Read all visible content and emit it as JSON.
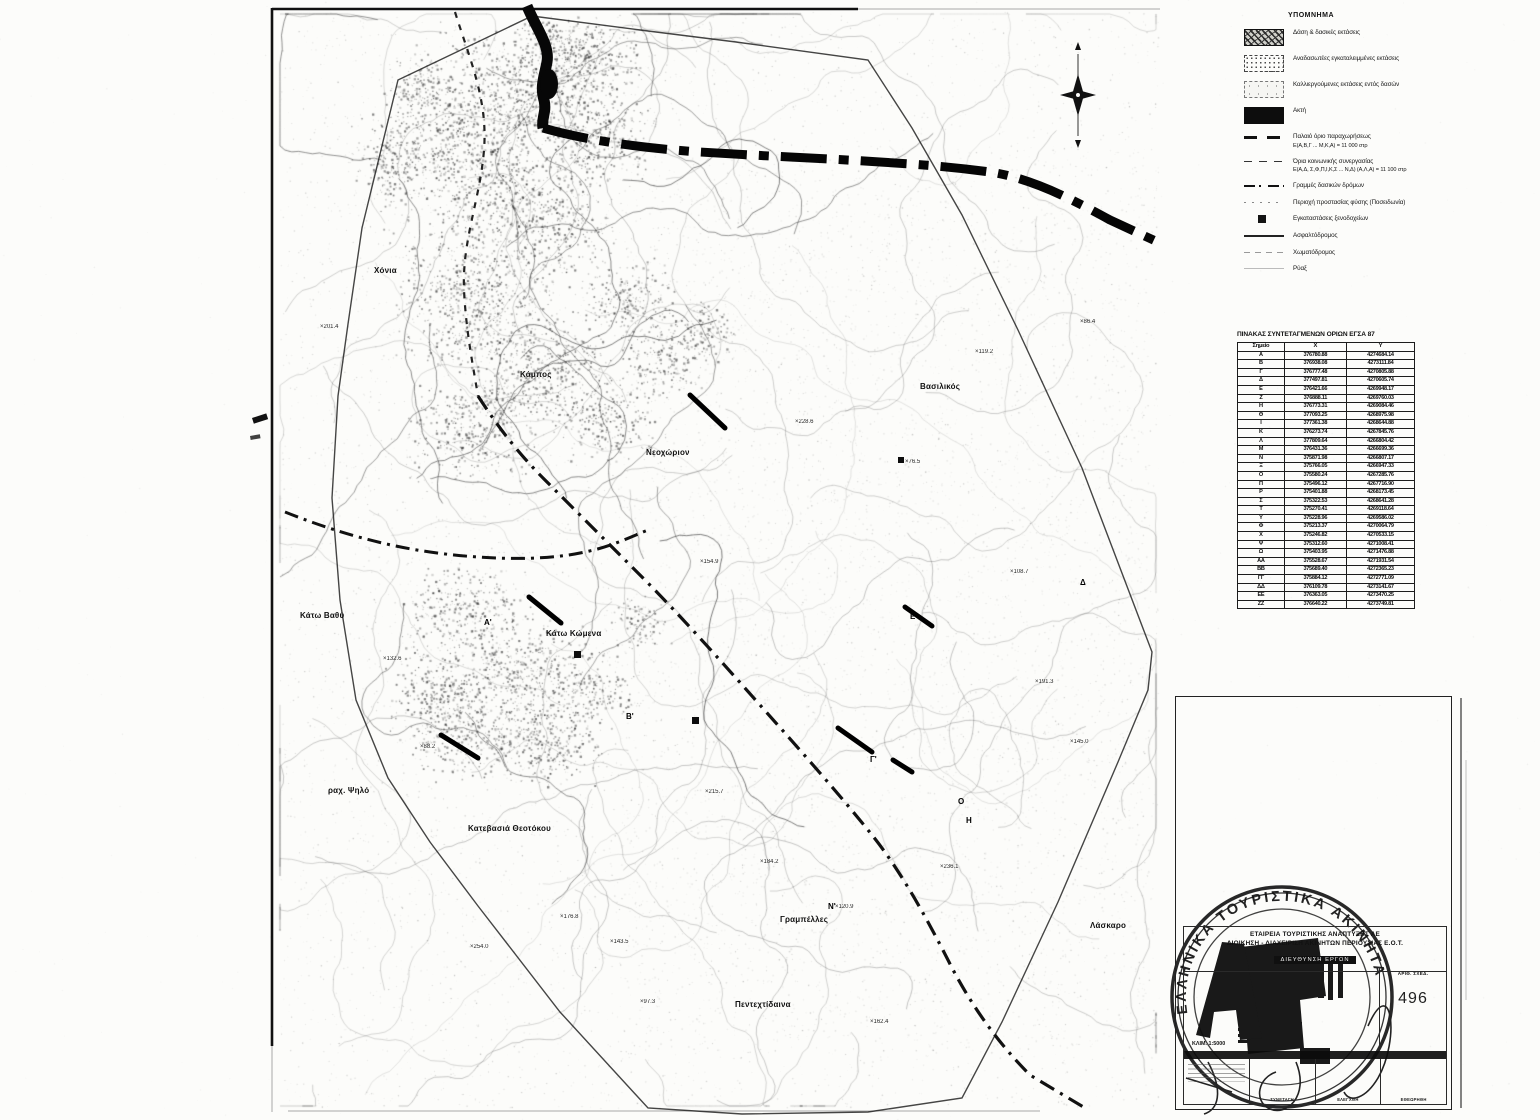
{
  "legend": {
    "title": "ΥΠΟΜΝΗΜΑ",
    "items": [
      {
        "type": "swatch-forest",
        "label": "Δάση & δασικές εκτάσεις"
      },
      {
        "type": "swatch-reforest",
        "label": "Αναδασωτέες εγκαταλειμμένες εκτάσεις"
      },
      {
        "type": "swatch-cultivated",
        "label": "Καλλιεργούμενες εκτάσεις εντός δασών"
      },
      {
        "type": "swatch-coast",
        "label": "Ακτή"
      },
      {
        "type": "line-old-boundary",
        "label": "Παλαιό όριο παραχωρήσεως",
        "sub": "Ε(Α,Β,Γ ... Μ,Κ,Α) = 11 000 στρ"
      },
      {
        "type": "line-common-boundary",
        "label": "Όρια κοινωνικής συνεργασίας",
        "sub": "Ε(Α,Δ, Σ,Φ,Π,Ι,Κ,Σ ... Ν,Δ) (Α,Λ,Α) = 11 100 στρ"
      },
      {
        "type": "line-forest-road",
        "label": "Γραμμές δασικών δρόμων"
      },
      {
        "type": "line-protection",
        "label": "Περιοχή προστασίας φύσης (Ποσειδωνία)"
      },
      {
        "type": "marker-hotel",
        "label": "Εγκαταστάσεις ξενοδοχείων"
      },
      {
        "type": "line-asphalt",
        "label": "Ασφαλτόδρομος"
      },
      {
        "type": "line-dirt",
        "label": "Χωματόδρομος"
      },
      {
        "type": "line-stream",
        "label": "Ρύαξ"
      }
    ]
  },
  "coords_table": {
    "title": "ΠΙΝΑΚΑΣ ΣΥΝΤΕΤΑΓΜΕΝΩΝ ΟΡΙΩΝ ΕΓΣΑ 87",
    "headers": [
      "Σημείο",
      "Χ",
      "Υ"
    ],
    "rows": [
      [
        "Α",
        "376780.88",
        "4274684.14"
      ],
      [
        "Β",
        "376938.08",
        "4273111.84"
      ],
      [
        "Γ",
        "376777.48",
        "4270805.88"
      ],
      [
        "Δ",
        "377497.81",
        "4270605.74"
      ],
      [
        "Ε",
        "376421.66",
        "4269948.17"
      ],
      [
        "Ζ",
        "376888.11",
        "4269760.03"
      ],
      [
        "Η",
        "376773.31",
        "4269084.46"
      ],
      [
        "Θ",
        "377093.25",
        "4268975.98"
      ],
      [
        "Ι",
        "377361.38",
        "4268644.88"
      ],
      [
        "Κ",
        "376273.74",
        "4267845.76"
      ],
      [
        "Λ",
        "377809.64",
        "4266804.42"
      ],
      [
        "Μ",
        "376431.36",
        "4266699.36"
      ],
      [
        "Ν",
        "375871.98",
        "4266807.17"
      ],
      [
        "Ξ",
        "375766.05",
        "4266947.33"
      ],
      [
        "Ο",
        "375580.24",
        "4267285.76"
      ],
      [
        "Π",
        "375496.12",
        "4267716.90"
      ],
      [
        "Ρ",
        "375401.88",
        "4268173.45"
      ],
      [
        "Σ",
        "375322.53",
        "4268641.28"
      ],
      [
        "Τ",
        "375270.41",
        "4269118.64"
      ],
      [
        "Υ",
        "375228.96",
        "4269586.02"
      ],
      [
        "Φ",
        "375213.37",
        "4270064.79"
      ],
      [
        "Χ",
        "375246.82",
        "4270533.15"
      ],
      [
        "Ψ",
        "375312.60",
        "4271008.41"
      ],
      [
        "Ω",
        "375403.95",
        "4271476.88"
      ],
      [
        "ΑΑ",
        "375528.67",
        "4271931.54"
      ],
      [
        "ΒΒ",
        "375689.40",
        "4272365.23"
      ],
      [
        "ΓΓ",
        "375884.12",
        "4272771.09"
      ],
      [
        "ΔΔ",
        "376109.78",
        "4273141.67"
      ],
      [
        "ΕΕ",
        "376363.05",
        "4273470.25"
      ],
      [
        "ΖΖ",
        "376640.22",
        "4273749.81"
      ]
    ]
  },
  "title_block": {
    "org_line1": "ΕΤΑΙΡΕΙΑ ΤΟΥΡΙΣΤΙΚΗΣ ΑΝΑΠΤΥΞΗΣ ΑΕ",
    "org_line2": "ΔΙΟΙΚΗΣΗ - ΔΙΑΧΕΙΡΙΣΗ ΑΚΙΝΗΤΩΝ ΠΕΡΙΟΥΣΙΑΣ Ε.Ο.Τ.",
    "org_line3": "ΔΙΕΥΘΥΝΣΗ ΕΡΓΩΝ",
    "drawing_no_label": "ΑΡΙΘ. ΣΧΕΔ.",
    "drawing_no": "496",
    "scale_text": "ΚΛΙΜ. 1:5000",
    "bottom_cell_labels": [
      "ΣΥΝΕΤΑΓΗ",
      "ΕΛΕΓΧΘΗ",
      "ΕΘΕΩΡΗΘΗ"
    ]
  },
  "stamp": {
    "ring_text": "ΕΛΛΗΝΙΚΑ  ΤΟΥΡΙΣΤΙΚΑ  ΑΚΙΝΗΤΑ"
  },
  "map": {
    "labels": [
      {
        "text": "Κάτω Βαθύ",
        "x": 300,
        "y": 611
      },
      {
        "text": "Βασιλικός",
        "x": 920,
        "y": 382
      },
      {
        "text": "Νεοχώριον",
        "x": 646,
        "y": 448
      },
      {
        "text": "Κατεβασιά Θεοτόκου",
        "x": 468,
        "y": 824
      },
      {
        "text": "Γραμπέλλες",
        "x": 780,
        "y": 915
      },
      {
        "text": "Λάσκαρο",
        "x": 1090,
        "y": 921
      },
      {
        "text": "Πεντεχτίδαινα",
        "x": 735,
        "y": 1000
      },
      {
        "text": "Κάτω Κώμενα",
        "x": 546,
        "y": 629
      },
      {
        "text": "ραχ. Ψηλό",
        "x": 328,
        "y": 786
      },
      {
        "text": "Χόνια",
        "x": 374,
        "y": 266
      },
      {
        "text": "Κάμπος",
        "x": 520,
        "y": 370
      }
    ],
    "elevation_marks": [
      {
        "v": "201.4",
        "x": 320,
        "y": 324
      },
      {
        "v": "132.6",
        "x": 383,
        "y": 656
      },
      {
        "v": "88.2",
        "x": 420,
        "y": 744
      },
      {
        "v": "254.0",
        "x": 470,
        "y": 944
      },
      {
        "v": "176.8",
        "x": 560,
        "y": 914
      },
      {
        "v": "143.5",
        "x": 610,
        "y": 939
      },
      {
        "v": "97.3",
        "x": 640,
        "y": 999
      },
      {
        "v": "215.7",
        "x": 705,
        "y": 789
      },
      {
        "v": "184.2",
        "x": 760,
        "y": 859
      },
      {
        "v": "120.9",
        "x": 835,
        "y": 904
      },
      {
        "v": "162.4",
        "x": 870,
        "y": 1019
      },
      {
        "v": "236.1",
        "x": 940,
        "y": 864
      },
      {
        "v": "108.7",
        "x": 1010,
        "y": 569
      },
      {
        "v": "191.3",
        "x": 1035,
        "y": 679
      },
      {
        "v": "145.0",
        "x": 1070,
        "y": 739
      },
      {
        "v": "76.5",
        "x": 905,
        "y": 459
      },
      {
        "v": "228.6",
        "x": 795,
        "y": 419
      },
      {
        "v": "154.9",
        "x": 700,
        "y": 559
      },
      {
        "v": "119.2",
        "x": 975,
        "y": 349
      },
      {
        "v": "86.4",
        "x": 1080,
        "y": 319
      }
    ],
    "vertex_letters": [
      {
        "t": "Δ",
        "x": 1080,
        "y": 578
      },
      {
        "t": "Ο",
        "x": 958,
        "y": 797
      },
      {
        "t": "Η",
        "x": 966,
        "y": 816
      },
      {
        "t": "Α'",
        "x": 484,
        "y": 618
      },
      {
        "t": "Β'",
        "x": 626,
        "y": 712
      },
      {
        "t": "Γ'",
        "x": 870,
        "y": 755
      },
      {
        "t": "Ε'",
        "x": 910,
        "y": 612
      },
      {
        "t": "Ν'",
        "x": 828,
        "y": 902
      }
    ]
  }
}
